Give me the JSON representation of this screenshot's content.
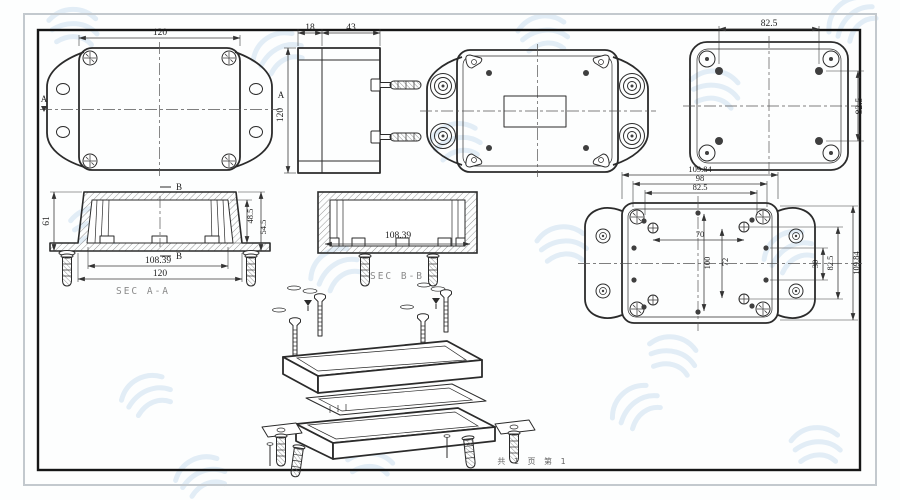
{
  "page": {
    "footer": "共 1 页  第 1",
    "colors": {
      "line": "#2b2b2b",
      "watermark": "#b9d4ec",
      "frame_outer": "#c3c9ce"
    }
  },
  "views": {
    "front": {
      "dim_width": "120",
      "dim_height": "120",
      "section_marker": "A"
    },
    "side": {
      "dim_lid": "18",
      "dim_body": "43",
      "dim_height": "120"
    },
    "lid_inner": {
      "dim_width": "82.5",
      "dim_height": "82.5"
    },
    "section_aa": {
      "label": "SEC A-A",
      "marker": "B",
      "dim_height": "61",
      "dim_inner_height": "48.5",
      "dim_outer_height": "54.5",
      "dim_inner_width": "108.39",
      "dim_outer_width": "120"
    },
    "section_bb": {
      "label": "SEC B-B",
      "dim_inner_width": "108.39"
    },
    "base_inner": {
      "dim_top_outer": "109.84",
      "dim_top_mid": "98",
      "dim_top_inner": "82.5",
      "dim_hole_span": "70",
      "dim_v_outer": "100",
      "dim_v_inner": "72",
      "dim_r_small": "30",
      "dim_r_mid": "82.5",
      "dim_r_outer": "109.84"
    }
  }
}
